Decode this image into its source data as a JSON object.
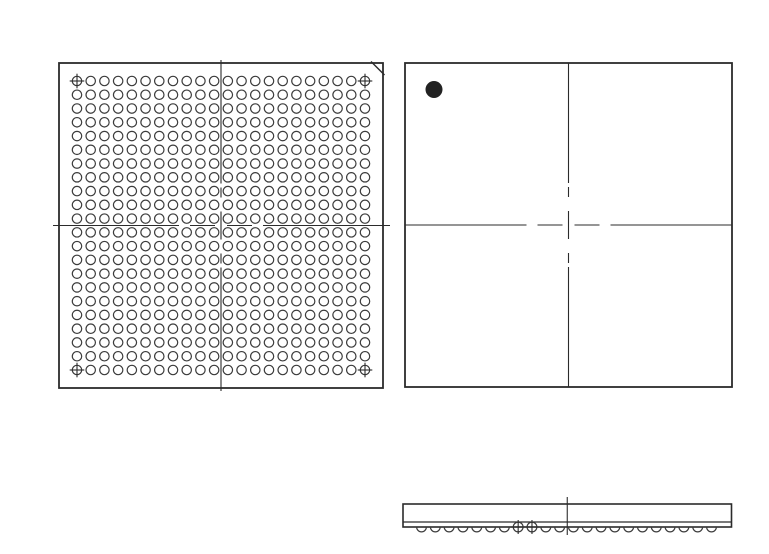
{
  "drawing": {
    "description": "BGA package outline drawing with three views: ball-grid bottom view, top view with pin-1 dot, and side profile view with solder balls",
    "colors": {
      "background": "#ffffff",
      "outline": "#2b2b2b",
      "ball_stroke": "#3c3c3c",
      "centerline": "#2f2f2f",
      "pin1_dot": "#222222"
    },
    "bottom_view": {
      "grid_rows": 22,
      "grid_cols": 22,
      "total_balls": 484,
      "fiducial_corner_balls": [
        "top-left",
        "top-right",
        "bottom-left",
        "bottom-right"
      ],
      "chamfer_corner": "top-right",
      "centerlines": "vertical and horizontal dash-dot centerlines through package middle"
    },
    "top_view": {
      "pin1_indicator": "filled round dot in upper-left quadrant",
      "centerlines": "vertical and horizontal dash-dot centerlines through package middle"
    },
    "side_view": {
      "ball_count": 22,
      "crosshair_ball_positions": [
        8,
        9
      ],
      "layers": [
        "package body",
        "substrate strip",
        "solder balls"
      ],
      "centerline": "vertical centerline at package middle"
    }
  }
}
